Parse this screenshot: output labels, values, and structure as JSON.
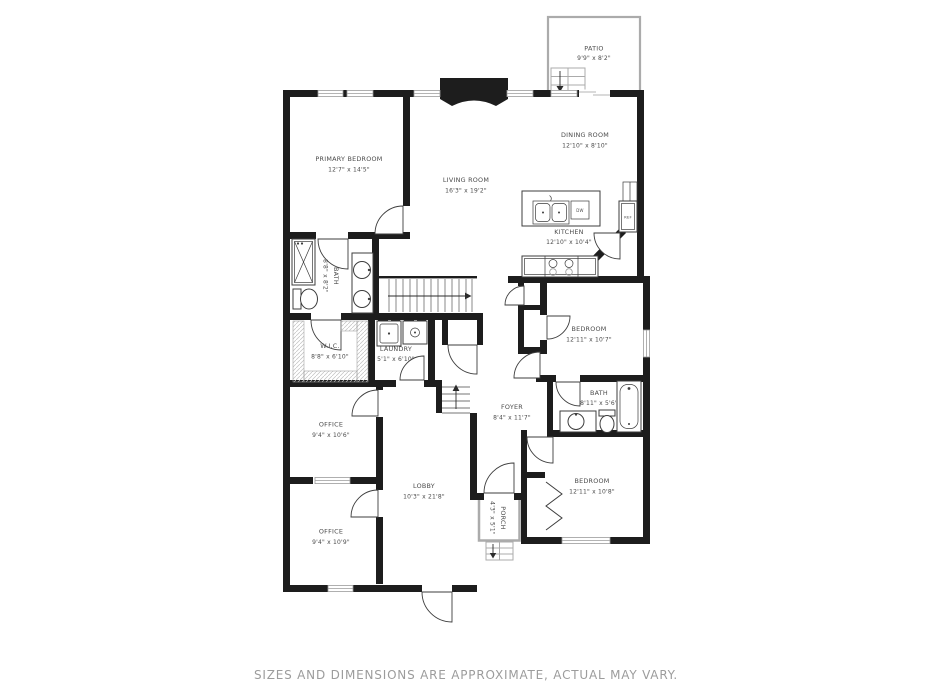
{
  "colors": {
    "wall": "#1d1d1d",
    "label": "#4b4b4b",
    "footer": "#9c9c9c",
    "window_gray": "#9b9b9b",
    "patio_gray": "#ababab"
  },
  "rooms": {
    "patio": {
      "name": "PATIO",
      "dims": "9'9\" x 8'2\""
    },
    "primary_bedroom": {
      "name": "PRIMARY BEDROOM",
      "dims": "12'7\" x 14'5\""
    },
    "living_room": {
      "name": "LIVING ROOM",
      "dims": "16'3\" x 19'2\""
    },
    "dining_room": {
      "name": "DINING ROOM",
      "dims": "12'10\" x 8'10\""
    },
    "kitchen": {
      "name": "KITCHEN",
      "dims": "12'10\" x 10'4\""
    },
    "primary_bath": {
      "name": "BATH",
      "dims": "8'8\" x 8'2\""
    },
    "wic": {
      "name": "W.I.C.",
      "dims": "8'8\" x 6'10\""
    },
    "laundry": {
      "name": "LAUNDRY",
      "dims": "5'1\" x 6'10\""
    },
    "bedroom_mid": {
      "name": "BEDROOM",
      "dims": "12'11\" x 10'7\""
    },
    "bath2": {
      "name": "BATH",
      "dims": "8'11\" x 5'6\""
    },
    "foyer": {
      "name": "FOYER",
      "dims": "8'4\" x 11'7\""
    },
    "bedroom_lower": {
      "name": "BEDROOM",
      "dims": "12'11\" x 10'8\""
    },
    "office_upper": {
      "name": "OFFICE",
      "dims": "9'4\" x 10'6\""
    },
    "office_lower": {
      "name": "OFFICE",
      "dims": "9'4\" x 10'9\""
    },
    "lobby": {
      "name": "LOBBY",
      "dims": "10'3\" x 21'8\""
    },
    "porch": {
      "name": "PORCH",
      "dims": "4'3\" x 5'1\""
    }
  },
  "appliances": {
    "dishwasher": "DW",
    "refrigerator": "REF"
  },
  "footer": {
    "disclaimer": "SIZES AND DIMENSIONS ARE APPROXIMATE, ACTUAL MAY VARY."
  }
}
